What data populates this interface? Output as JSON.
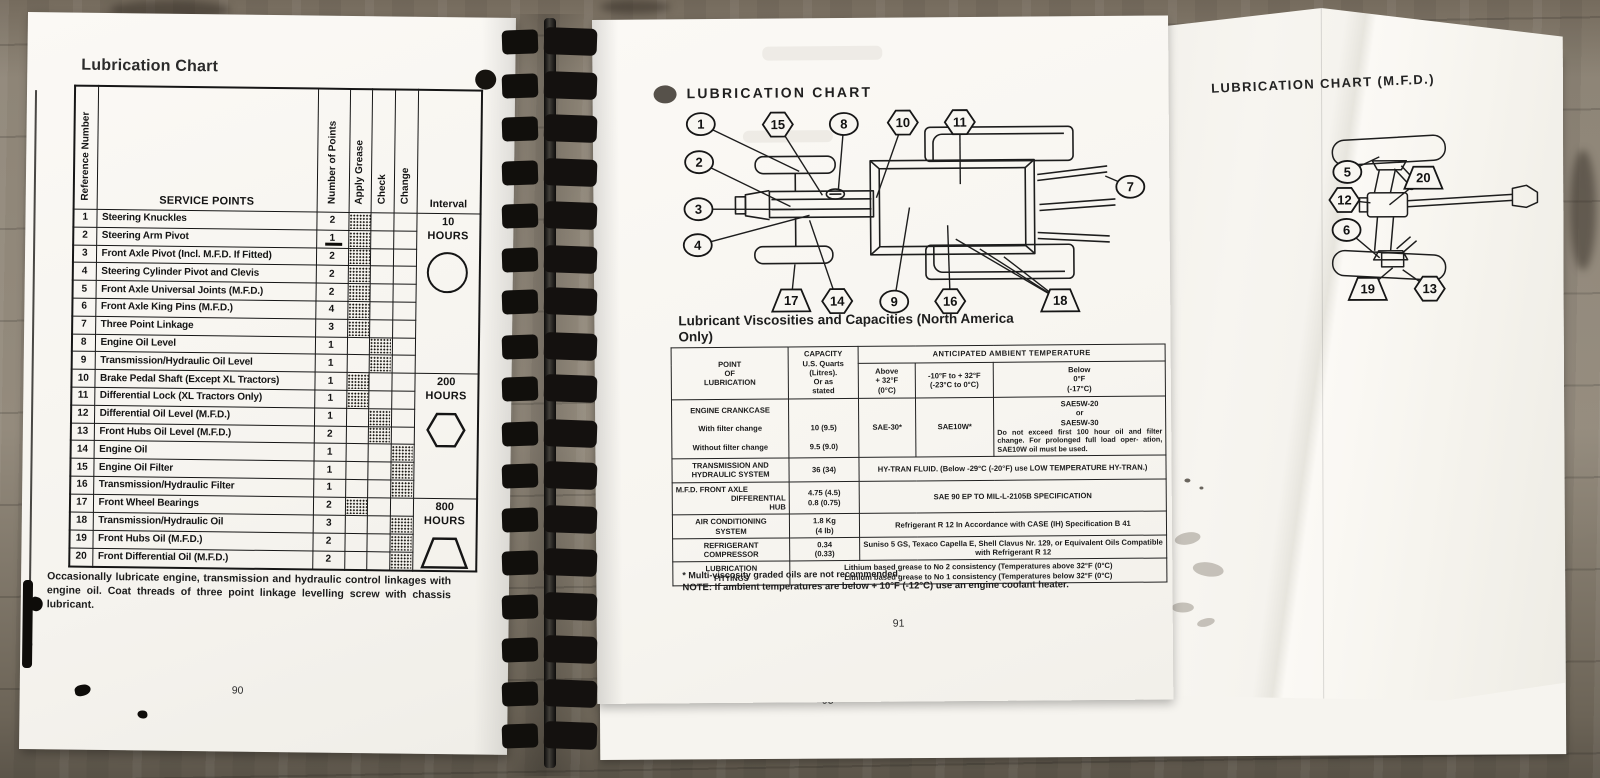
{
  "left_page": {
    "title": "Lubrication Chart",
    "page_number": "90",
    "table": {
      "headers": {
        "reference_number": "Reference Number",
        "service_points": "SERVICE POINTS",
        "number_of_points": "Number of Points",
        "apply_grease": "Apply Grease",
        "check": "Check",
        "change": "Change",
        "interval": "Interval"
      },
      "rows": [
        {
          "ref": "1",
          "service": "Steering Knuckles",
          "points": "2",
          "mark": "grease"
        },
        {
          "ref": "2",
          "service": "Steering Arm Pivot",
          "points": "1",
          "mark": "grease"
        },
        {
          "ref": "3",
          "service": "Front Axle Pivot (Incl. M.F.D. If Fitted)",
          "points": "2",
          "mark": "grease"
        },
        {
          "ref": "4",
          "service": "Steering Cylinder Pivot and Clevis",
          "points": "2",
          "mark": "grease"
        },
        {
          "ref": "5",
          "service": "Front Axle Universal Joints (M.F.D.)",
          "points": "2",
          "mark": "grease"
        },
        {
          "ref": "6",
          "service": "Front Axle King Pins (M.F.D.)",
          "points": "4",
          "mark": "grease"
        },
        {
          "ref": "7",
          "service": "Three Point Linkage",
          "points": "3",
          "mark": "grease"
        },
        {
          "ref": "8",
          "service": "Engine Oil Level",
          "points": "1",
          "mark": "check"
        },
        {
          "ref": "9",
          "service": "Transmission/Hydraulic Oil Level",
          "points": "1",
          "mark": "check"
        },
        {
          "ref": "10",
          "service": "Brake Pedal Shaft (Except XL Tractors)",
          "points": "1",
          "mark": "grease"
        },
        {
          "ref": "11",
          "service": "Differential Lock (XL Tractors Only)",
          "points": "1",
          "mark": "grease"
        },
        {
          "ref": "12",
          "service": "Differential Oil Level (M.F.D.)",
          "points": "1",
          "mark": "check"
        },
        {
          "ref": "13",
          "service": "Front Hubs Oil Level (M.F.D.)",
          "points": "2",
          "mark": "check"
        },
        {
          "ref": "14",
          "service": "Engine Oil",
          "points": "1",
          "mark": "change"
        },
        {
          "ref": "15",
          "service": "Engine Oil Filter",
          "points": "1",
          "mark": "change"
        },
        {
          "ref": "16",
          "service": "Transmission/Hydraulic Filter",
          "points": "1",
          "mark": "change"
        },
        {
          "ref": "17",
          "service": "Front Wheel Bearings",
          "points": "2",
          "mark": "grease"
        },
        {
          "ref": "18",
          "service": "Transmission/Hydraulic Oil",
          "points": "3",
          "mark": "change"
        },
        {
          "ref": "19",
          "service": "Front Hubs Oil (M.F.D.)",
          "points": "2",
          "mark": "change"
        },
        {
          "ref": "20",
          "service": "Front Differential Oil (M.F.D.)",
          "points": "2",
          "mark": "change"
        }
      ],
      "interval_groups": [
        {
          "value": "10",
          "unit": "HOURS",
          "symbol": "circle",
          "rows": 9
        },
        {
          "value": "200",
          "unit": "HOURS",
          "symbol": "hexagon",
          "rows": 7
        },
        {
          "value": "800",
          "unit": "HOURS",
          "symbol": "trapezoid",
          "rows": 4
        }
      ]
    },
    "footnote": "Occasionally lubricate engine, transmission and hydraulic control linkages with engine oil. Coat threads of three point linkage levelling screw with chassis lubricant."
  },
  "middle_page": {
    "title": "LUBRICATION CHART",
    "page_number": "91",
    "diagram": {
      "callouts": [
        {
          "n": "1",
          "shape": "circle",
          "x": 44,
          "y": 35,
          "leaders": [
            [
              142,
              83
            ]
          ]
        },
        {
          "n": "15",
          "shape": "hexagon",
          "x": 121,
          "y": 36,
          "leaders": [
            [
              165,
              107
            ]
          ]
        },
        {
          "n": "8",
          "shape": "circle",
          "x": 187,
          "y": 36,
          "leaders": [
            [
              181,
              102
            ]
          ]
        },
        {
          "n": "10",
          "shape": "hexagon",
          "x": 246,
          "y": 35,
          "leaders": [
            [
              219,
              110
            ]
          ]
        },
        {
          "n": "11",
          "shape": "hexagon",
          "x": 303,
          "y": 35,
          "leaders": [
            [
              303,
              97
            ]
          ]
        },
        {
          "n": "2",
          "shape": "circle",
          "x": 42,
          "y": 73,
          "leaders": [
            [
              133,
              118
            ]
          ]
        },
        {
          "n": "3",
          "shape": "circle",
          "x": 41,
          "y": 120,
          "leaders": [
            [
              137,
              121
            ]
          ]
        },
        {
          "n": "4",
          "shape": "circle",
          "x": 40,
          "y": 156,
          "leaders": [
            [
              152,
              127
            ]
          ]
        },
        {
          "n": "7",
          "shape": "circle",
          "x": 473,
          "y": 101,
          "leaders": [
            [
              448,
              90
            ]
          ]
        },
        {
          "n": "17",
          "shape": "trapezoid",
          "x": 133,
          "y": 212,
          "leaders": [
            [
              137,
              176
            ]
          ]
        },
        {
          "n": "14",
          "shape": "hexagon",
          "x": 179,
          "y": 213,
          "leaders": [
            [
              152,
              132
            ]
          ]
        },
        {
          "n": "9",
          "shape": "circle",
          "x": 236,
          "y": 214,
          "leaders": [
            [
              252,
              120
            ]
          ]
        },
        {
          "n": "16",
          "shape": "hexagon",
          "x": 292,
          "y": 214,
          "leaders": [
            [
              290,
              138
            ]
          ]
        },
        {
          "n": "18",
          "shape": "trapezoid",
          "x": 402,
          "y": 214,
          "leaders": [
            [
              298,
              152
            ],
            [
              322,
              162
            ],
            [
              346,
              170
            ]
          ]
        }
      ]
    },
    "capacities": {
      "heading_line1": "Lubricant Viscosities and Capacities (North America",
      "heading_line2": "Only)",
      "header": {
        "point": [
          "POINT",
          "OF",
          "LUBRICATION"
        ],
        "capacity": [
          "CAPACITY",
          "U.S. Quarts",
          "(Litres).",
          "Or as",
          "stated"
        ],
        "temp_band": "ANTICIPATED AMBIENT TEMPERATURE",
        "temp_cols": [
          [
            "Above",
            "+ 32°F",
            "(0°C)"
          ],
          [
            "-10°F to + 32°F",
            "(-23°C to 0°C)"
          ],
          [
            "Below",
            "0°F",
            "(-17°C)"
          ]
        ]
      },
      "rows": [
        {
          "point": [
            "ENGINE CRANKCASE",
            "",
            "With filter change",
            "",
            "Without filter change"
          ],
          "capacity": [
            "",
            "",
            "10 (9.5)",
            "",
            "9.5 (9.0)"
          ],
          "temp_above": "SAE-30*",
          "temp_mid": "SAE10W*",
          "temp_below": {
            "lines": [
              "SAE5W-20",
              "or",
              "SAE5W-30"
            ],
            "para": "Do not exceed first 100 hour oil and filter change. For prolonged full load oper- ation, SAE10W oil must be used."
          }
        },
        {
          "point": [
            "TRANSMISSION AND",
            "HYDRAULIC SYSTEM"
          ],
          "capacity": [
            "36 (34)"
          ],
          "span": "HY-TRAN FLUID.  (Below -29°C (-20°F) use LOW TEMPERATURE HY-TRAN.)"
        },
        {
          "point": [
            "M.F.D. FRONT AXLE",
            "DIFFERENTIAL",
            "HUB"
          ],
          "point_align": "right",
          "capacity": [
            "4.75 (4.5)",
            "0.8 (0.75)"
          ],
          "span": "SAE 90 EP TO MIL-L-2105B SPECIFICATION"
        },
        {
          "point": [
            "AIR CONDITIONING",
            "SYSTEM"
          ],
          "capacity": [
            "1.8 Kg",
            "(4 lb)"
          ],
          "span": "Refrigerant R 12 In Accordance with CASE (IH) Specification B 41"
        },
        {
          "point": [
            "REFRIGERANT",
            "COMPRESSOR"
          ],
          "capacity": [
            "0.34",
            "(0.33)"
          ],
          "span": "Suniso 5 GS, Texaco Capella E, Shell Clavus Nr. 129, or Equivalent Oils Compatible with Refrigerant R 12"
        },
        {
          "point": [
            "LUBRICATION",
            "FITTINGS"
          ],
          "wide": [
            "Lithium based grease to No 2 consistency (Temperatures above 32°F (0°C)",
            "Lithium based grease to No 1 consistency (Temperatures below 32°F (0°C)"
          ]
        }
      ]
    },
    "footnote_star": "* Multi-viscosity graded oils are not recommended.",
    "note_label": "NOTE:",
    "note_body": "If ambient temperatures are below + 10°F (-12°C) use an engine coolant heater."
  },
  "back_page": {
    "page_number": "93"
  },
  "right_page": {
    "title": "LUBRICATION CHART (M.F.D.)",
    "diagram": {
      "callouts": [
        {
          "n": "5",
          "shape": "circle",
          "x": 63,
          "y": 47,
          "leaders": [
            [
              95,
              32
            ]
          ]
        },
        {
          "n": "20",
          "shape": "trapezoid",
          "x": 139,
          "y": 53,
          "leaders": [
            [
              105,
              80
            ]
          ]
        },
        {
          "n": "12",
          "shape": "hexagon",
          "x": 60,
          "y": 75,
          "leaders": [
            [
              86,
              78
            ]
          ]
        },
        {
          "n": "6",
          "shape": "circle",
          "x": 62,
          "y": 105,
          "leaders": [
            [
              95,
              133
            ]
          ]
        },
        {
          "n": "19",
          "shape": "trapezoid",
          "x": 83,
          "y": 164,
          "leaders": [
            [
              108,
              143
            ]
          ]
        },
        {
          "n": "13",
          "shape": "hexagon",
          "x": 145,
          "y": 164,
          "leaders": [
            [
              118,
              145
            ]
          ]
        }
      ]
    }
  }
}
